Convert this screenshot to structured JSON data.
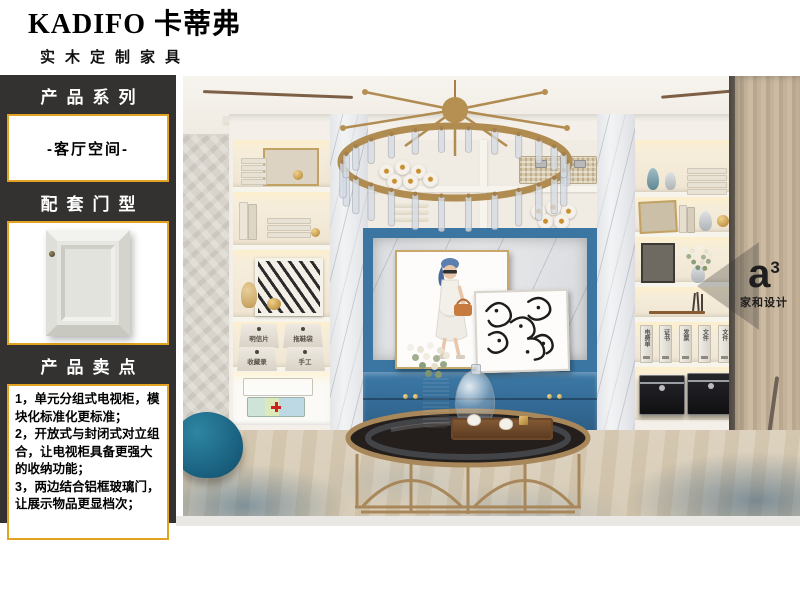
{
  "brand": {
    "name": "KADIFO 卡蒂弗",
    "tagline": "实木定制家具"
  },
  "sidebar": {
    "series": {
      "title": "产品系列",
      "value": "-客厅空间-"
    },
    "door": {
      "title": "配套门型"
    },
    "selling": {
      "title": "产品卖点",
      "points": [
        "1，单元分组式电视柜，模块化标准化更标准；",
        "2，开放式与封闭式对立组合，让电视柜具备更强大的收纳功能；",
        "3，两边结合铝框玻璃门，让展示物品更显档次；"
      ]
    }
  },
  "scene": {
    "bin_labels": [
      "明信片",
      "拖鞋袋",
      "收藏录",
      "手工"
    ],
    "file_labels": [
      "电费单",
      "证书",
      "发票",
      "文件",
      "文件"
    ],
    "watermark": {
      "logo": "a",
      "sup": "3",
      "caption": "家和设计"
    }
  },
  "colors": {
    "accent_gold": "#e2a320",
    "sidebar_bg": "#333230",
    "niche_blue": "#3b76a3",
    "brass": "#a8875a",
    "curtain_beige": "#c4b299",
    "pouf_teal": "#1a6180"
  }
}
